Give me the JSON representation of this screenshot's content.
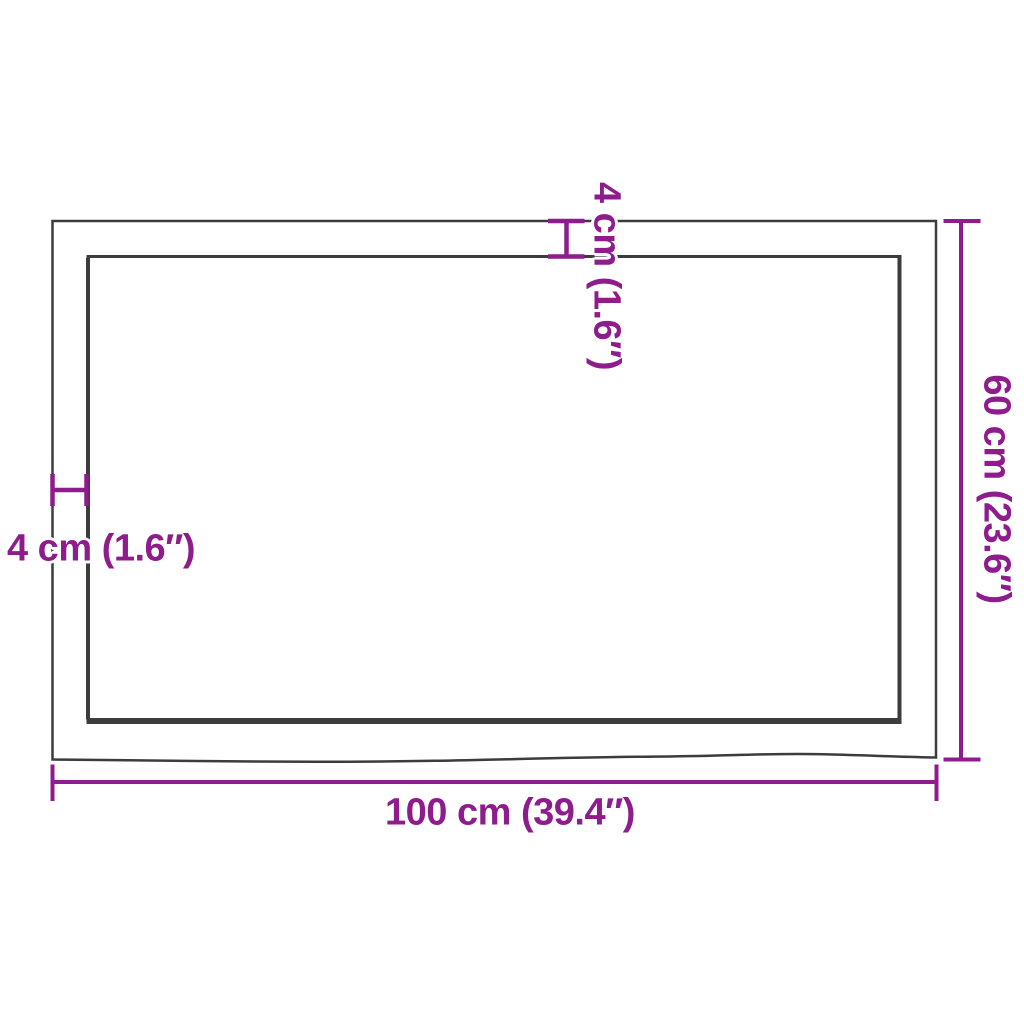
{
  "colors": {
    "dimension": "#8e1c8c",
    "outline": "#3c3c3c",
    "halo": "#ffffff",
    "background": "#ffffff"
  },
  "labels": {
    "width": "100 cm (39.4″)",
    "depth": "60 cm (23.6″)",
    "thickness_side": "4 cm (1.6″)",
    "thickness_top": "4 cm (1.6″)"
  }
}
